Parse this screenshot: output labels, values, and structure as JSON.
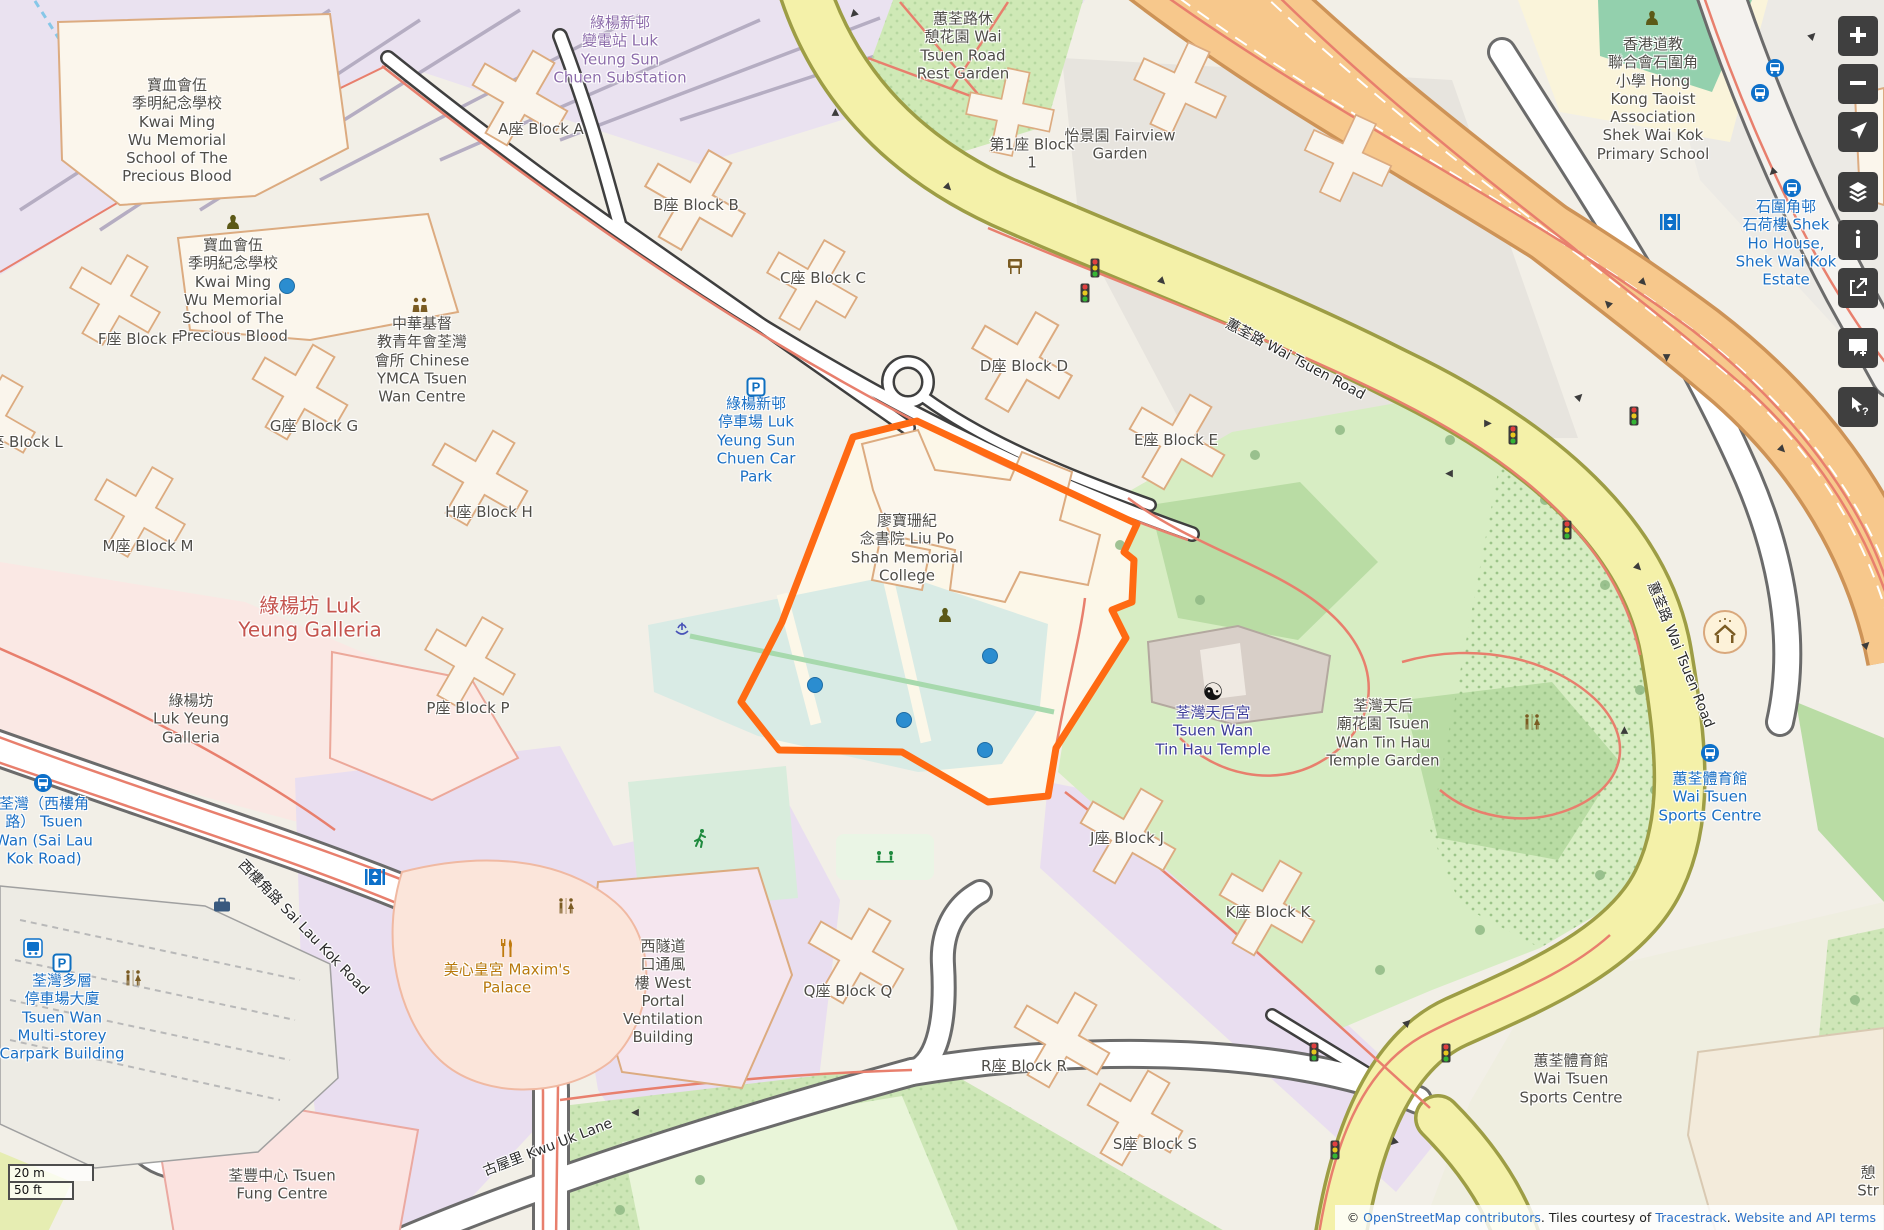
{
  "map": {
    "colors": {
      "highlight_orange": "#ff6a13",
      "marker_blue": "#2b8dd0",
      "road_yellow": "#f4f1a9",
      "road_trunk_orange": "#f7c88c",
      "park_green": "#d7edc3",
      "water_teal": "#d9ebe5",
      "label_blue": "#1a6fc4",
      "label_navy": "#3d3d99",
      "label_red": "#c4544e"
    },
    "labels": [
      {
        "name": "label-school-kwai-ming-north",
        "lines": [
          "寶血會伍",
          "季明紀念學校",
          "Kwai Ming",
          "Wu Memorial",
          "School of The",
          "Precious Blood"
        ],
        "x": 177,
        "y": 131,
        "cls": "poi"
      },
      {
        "name": "label-school-kwai-ming-south",
        "lines": [
          "寶血會伍",
          "季明紀念學校",
          "Kwai Ming",
          "Wu Memorial",
          "School of The",
          "Precious Blood"
        ],
        "x": 233,
        "y": 291,
        "cls": "poi"
      },
      {
        "name": "label-block-a",
        "lines": [
          "A座 Block A"
        ],
        "x": 541,
        "y": 129,
        "cls": "poi"
      },
      {
        "name": "label-block-b",
        "lines": [
          "B座 Block B"
        ],
        "x": 696,
        "y": 205,
        "cls": "poi"
      },
      {
        "name": "label-block-c",
        "lines": [
          "C座 Block C"
        ],
        "x": 823,
        "y": 278,
        "cls": "poi"
      },
      {
        "name": "label-block-d",
        "lines": [
          "D座 Block D"
        ],
        "x": 1024,
        "y": 366,
        "cls": "poi"
      },
      {
        "name": "label-block-e",
        "lines": [
          "E座 Block E"
        ],
        "x": 1176,
        "y": 440,
        "cls": "poi"
      },
      {
        "name": "label-block-f",
        "lines": [
          "F座 Block F"
        ],
        "x": 139,
        "y": 339,
        "cls": "poi"
      },
      {
        "name": "label-block-g",
        "lines": [
          "G座 Block G"
        ],
        "x": 314,
        "y": 426,
        "cls": "poi"
      },
      {
        "name": "label-block-h",
        "lines": [
          "H座 Block H"
        ],
        "x": 489,
        "y": 512,
        "cls": "poi"
      },
      {
        "name": "label-block-m",
        "lines": [
          "M座 Block M"
        ],
        "x": 148,
        "y": 546,
        "cls": "poi"
      },
      {
        "name": "label-block-l",
        "lines": [
          "座 Block L"
        ],
        "x": 26,
        "y": 442,
        "cls": "poi"
      },
      {
        "name": "label-block-p",
        "lines": [
          "P座 Block P"
        ],
        "x": 468,
        "y": 708,
        "cls": "poi"
      },
      {
        "name": "label-block-q",
        "lines": [
          "Q座 Block Q"
        ],
        "x": 848,
        "y": 991,
        "cls": "poi"
      },
      {
        "name": "label-block-r",
        "lines": [
          "R座 Block R"
        ],
        "x": 1024,
        "y": 1066,
        "cls": "poi"
      },
      {
        "name": "label-block-s",
        "lines": [
          "S座 Block S"
        ],
        "x": 1155,
        "y": 1144,
        "cls": "poi"
      },
      {
        "name": "label-block-j",
        "lines": [
          "J座 Block J"
        ],
        "x": 1127,
        "y": 838,
        "cls": "poi"
      },
      {
        "name": "label-block-k",
        "lines": [
          "K座 Block K"
        ],
        "x": 1268,
        "y": 912,
        "cls": "poi"
      },
      {
        "name": "label-block-1",
        "lines": [
          "第1座 Block",
          "1"
        ],
        "x": 1032,
        "y": 154,
        "cls": "poi"
      },
      {
        "name": "label-fairview-garden",
        "lines": [
          "怡景園 Fairview",
          "Garden"
        ],
        "x": 1120,
        "y": 145,
        "cls": "poi"
      },
      {
        "name": "label-substation",
        "lines": [
          "綠楊新邨",
          "變電站 Luk",
          "Yeung Sun",
          "Chuen Substation"
        ],
        "x": 620,
        "y": 50,
        "cls": "purple"
      },
      {
        "name": "label-rest-garden",
        "lines": [
          "蕙荃路休",
          "憩花園 Wai",
          "Tsuen Road",
          "Rest Garden"
        ],
        "x": 963,
        "y": 46,
        "cls": "poi"
      },
      {
        "name": "label-ymca",
        "lines": [
          "中華基督",
          "教青年會荃灣",
          "會所 Chinese",
          "YMCA Tsuen",
          "Wan Centre"
        ],
        "x": 422,
        "y": 360,
        "cls": "poi"
      },
      {
        "name": "label-luk-yeung-car-park",
        "lines": [
          "綠楊新邨",
          "停車場 Luk",
          "Yeung Sun",
          "Chuen Car",
          "Park"
        ],
        "x": 756,
        "y": 440,
        "cls": "blue"
      },
      {
        "name": "label-liu-po-shan-college",
        "lines": [
          "廖寶珊紀",
          "念書院 Liu Po",
          "Shan Memorial",
          "College"
        ],
        "x": 907,
        "y": 548,
        "cls": "poi"
      },
      {
        "name": "label-tin-hau-temple",
        "lines": [
          "荃灣天后宮",
          "Tsuen Wan",
          "Tin Hau Temple"
        ],
        "x": 1213,
        "y": 731,
        "cls": "navy"
      },
      {
        "name": "label-tin-hau-temple-garden",
        "lines": [
          "荃灣天后",
          "廟花園 Tsuen",
          "Wan Tin Hau",
          "Temple Garden"
        ],
        "x": 1383,
        "y": 733,
        "cls": "poi"
      },
      {
        "name": "label-luk-yeung-galleria-mall",
        "lines": [
          "綠楊坊 Luk",
          "Yeung Galleria"
        ],
        "x": 310,
        "y": 618,
        "cls": "red",
        "size": 20
      },
      {
        "name": "label-luk-yeung-galleria-bldg",
        "lines": [
          "綠楊坊",
          "Luk Yeung",
          "Galleria"
        ],
        "x": 191,
        "y": 719,
        "cls": "poi"
      },
      {
        "name": "label-tsuen-wan-sai-lau-kok-stop",
        "lines": [
          "荃灣（西樓角",
          "路） Tsuen",
          "Wan (Sai Lau",
          "Kok Road)"
        ],
        "x": 44,
        "y": 831,
        "cls": "blue"
      },
      {
        "name": "label-multistorey-carpark",
        "lines": [
          "荃灣多層",
          "停車場大廈",
          "Tsuen Wan",
          "Multi-storey",
          "Carpark Building"
        ],
        "x": 62,
        "y": 1017,
        "cls": "blue"
      },
      {
        "name": "label-maxims-palace",
        "lines": [
          "美心皇宮 Maxim's",
          "Palace"
        ],
        "x": 507,
        "y": 979,
        "cls": "amber"
      },
      {
        "name": "label-west-portal-ventilation",
        "lines": [
          "西隧道",
          "口通風",
          "樓 West",
          "Portal",
          "Ventilation",
          "Building"
        ],
        "x": 663,
        "y": 992,
        "cls": "poi"
      },
      {
        "name": "label-tsuen-fung-centre",
        "lines": [
          "荃豐中心 Tsuen",
          "Fung Centre"
        ],
        "x": 282,
        "y": 1185,
        "cls": "poi"
      },
      {
        "name": "label-wai-tsuen-sports-centre",
        "lines": [
          "蕙荃體育館",
          "Wai Tsuen",
          "Sports Centre"
        ],
        "x": 1571,
        "y": 1079,
        "cls": "poi"
      },
      {
        "name": "label-wai-tsuen-sports-centre-stop",
        "lines": [
          "蕙荃體育館",
          "Wai Tsuen",
          "Sports Centre"
        ],
        "x": 1710,
        "y": 797,
        "cls": "blue"
      },
      {
        "name": "label-shek-ho-house",
        "lines": [
          "石圍角邨",
          "石荷樓 Shek",
          "Ho House,",
          "Shek Wai Kok",
          "Estate"
        ],
        "x": 1786,
        "y": 243,
        "cls": "blue"
      },
      {
        "name": "label-taoist-primary-school",
        "lines": [
          "香港道教",
          "聯合會石圍角",
          "小學 Hong",
          "Kong Taoist",
          "Association",
          "Shek Wai Kok",
          "Primary School"
        ],
        "x": 1653,
        "y": 99,
        "cls": "poi"
      },
      {
        "name": "street-sai-lau-kok-road",
        "lines": [
          "西樓角路 Sai Lau Kok Road"
        ],
        "x": 303,
        "y": 928,
        "cls": "street",
        "rot": 46
      },
      {
        "name": "street-kwu-uk-lane",
        "lines": [
          "古屋里 Kwu Uk Lane"
        ],
        "x": 548,
        "y": 1148,
        "cls": "street",
        "rot": -21
      },
      {
        "name": "street-wai-tsuen-road-north",
        "lines": [
          "蕙荃路 Wai Tsuen Road"
        ],
        "x": 1295,
        "y": 360,
        "cls": "street",
        "rot": 28
      },
      {
        "name": "street-wai-tsuen-road-east",
        "lines": [
          "蕙荃路 Wai Tsuen Road"
        ],
        "x": 1680,
        "y": 655,
        "cls": "street",
        "rot": 68
      },
      {
        "name": "label-partial-street",
        "lines": [
          "憩",
          "Str"
        ],
        "x": 1868,
        "y": 1182,
        "cls": "poi"
      }
    ],
    "icons": [
      {
        "name": "school-icon",
        "type": "school",
        "x": 233,
        "y": 222
      },
      {
        "name": "school-icon",
        "type": "school",
        "x": 945,
        "y": 615
      },
      {
        "name": "school-icon",
        "type": "school",
        "x": 1652,
        "y": 18
      },
      {
        "name": "parking-icon",
        "type": "parking",
        "x": 756,
        "y": 387
      },
      {
        "name": "parking-icon",
        "type": "parking",
        "x": 62,
        "y": 963
      },
      {
        "name": "bus-stop-icon",
        "type": "bus",
        "x": 43,
        "y": 783
      },
      {
        "name": "bus-stop-icon",
        "type": "bus",
        "x": 1710,
        "y": 753
      },
      {
        "name": "bus-stop-icon",
        "type": "bus",
        "x": 1775,
        "y": 68
      },
      {
        "name": "bus-stop-icon",
        "type": "bus",
        "x": 1760,
        "y": 93
      },
      {
        "name": "bus-stop-icon",
        "type": "bus",
        "x": 1792,
        "y": 188
      },
      {
        "name": "bus-station-icon",
        "type": "bus_square",
        "x": 33,
        "y": 948
      },
      {
        "name": "elevator-icon",
        "type": "elevator",
        "x": 375,
        "y": 877
      },
      {
        "name": "elevator-icon",
        "type": "elevator",
        "x": 1670,
        "y": 222
      },
      {
        "name": "toilets-icon",
        "type": "toilets",
        "x": 133,
        "y": 978
      },
      {
        "name": "toilets-icon",
        "type": "toilets",
        "x": 566,
        "y": 906
      },
      {
        "name": "toilets-icon",
        "type": "toilets",
        "x": 1532,
        "y": 722
      },
      {
        "name": "restaurant-icon",
        "type": "restaurant",
        "x": 507,
        "y": 948
      },
      {
        "name": "community-centre-icon",
        "type": "community",
        "x": 420,
        "y": 305
      },
      {
        "name": "yin-yang-icon",
        "type": "yinyang",
        "x": 1213,
        "y": 692
      },
      {
        "name": "fountain-icon",
        "type": "fountain",
        "x": 682,
        "y": 629
      },
      {
        "name": "running-track-icon",
        "type": "runner",
        "x": 700,
        "y": 838
      },
      {
        "name": "playground-icon",
        "type": "playground",
        "x": 885,
        "y": 856
      },
      {
        "name": "noticeboard-icon",
        "type": "board",
        "x": 1015,
        "y": 266
      },
      {
        "name": "shelter-icon",
        "type": "shelter",
        "x": 1725,
        "y": 632
      },
      {
        "name": "luggage-icon",
        "type": "luggage",
        "x": 222,
        "y": 905
      }
    ],
    "markers": [
      {
        "x": 287,
        "y": 286
      },
      {
        "x": 815,
        "y": 685
      },
      {
        "x": 990,
        "y": 656
      },
      {
        "x": 904,
        "y": 720
      },
      {
        "x": 985,
        "y": 750
      }
    ],
    "traffic_lights": [
      {
        "x": 1095,
        "y": 268
      },
      {
        "x": 1085,
        "y": 293
      },
      {
        "x": 1513,
        "y": 435
      },
      {
        "x": 1634,
        "y": 416
      },
      {
        "x": 1567,
        "y": 530
      },
      {
        "x": 1314,
        "y": 1052
      },
      {
        "x": 1446,
        "y": 1053
      },
      {
        "x": 1335,
        "y": 1150
      }
    ],
    "arrows": [
      {
        "x": 853,
        "y": 14,
        "dir": "sw"
      },
      {
        "x": 836,
        "y": 112,
        "dir": "n"
      },
      {
        "x": 948,
        "y": 188,
        "dir": "se"
      },
      {
        "x": 1162,
        "y": 282,
        "dir": "se"
      },
      {
        "x": 1488,
        "y": 424,
        "dir": "e"
      },
      {
        "x": 1449,
        "y": 473,
        "dir": "w"
      },
      {
        "x": 1638,
        "y": 568,
        "dir": "se"
      },
      {
        "x": 1625,
        "y": 730,
        "dir": "n"
      },
      {
        "x": 1408,
        "y": 1023,
        "dir": "ne"
      },
      {
        "x": 1393,
        "y": 1142,
        "dir": "sw"
      },
      {
        "x": 1813,
        "y": 36,
        "dir": "ne"
      },
      {
        "x": 1772,
        "y": 172,
        "dir": "sw"
      },
      {
        "x": 1782,
        "y": 450,
        "dir": "se"
      },
      {
        "x": 1867,
        "y": 645,
        "dir": "ne"
      },
      {
        "x": 1643,
        "y": 283,
        "dir": "se"
      },
      {
        "x": 1608,
        "y": 303,
        "dir": "nw"
      },
      {
        "x": 1666,
        "y": 358,
        "dir": "s"
      },
      {
        "x": 1580,
        "y": 397,
        "dir": "ne"
      },
      {
        "x": 635,
        "y": 1112,
        "dir": "w"
      }
    ],
    "controls": [
      {
        "name": "zoom-in"
      },
      {
        "name": "zoom-out"
      },
      {
        "name": "show-my-location"
      },
      {
        "name": "layers"
      },
      {
        "name": "map-key"
      },
      {
        "name": "share"
      },
      {
        "name": "add-note"
      },
      {
        "name": "query-features"
      }
    ],
    "scalebar": {
      "metric": "20 m",
      "imperial": "50 ft"
    },
    "attribution": {
      "prefix": "© ",
      "osm_link": "OpenStreetMap contributors",
      "middle": ". Tiles courtesy of ",
      "tracestrack_link": "Tracestrack",
      "separator": ". ",
      "terms_link": "Website and API terms"
    }
  }
}
